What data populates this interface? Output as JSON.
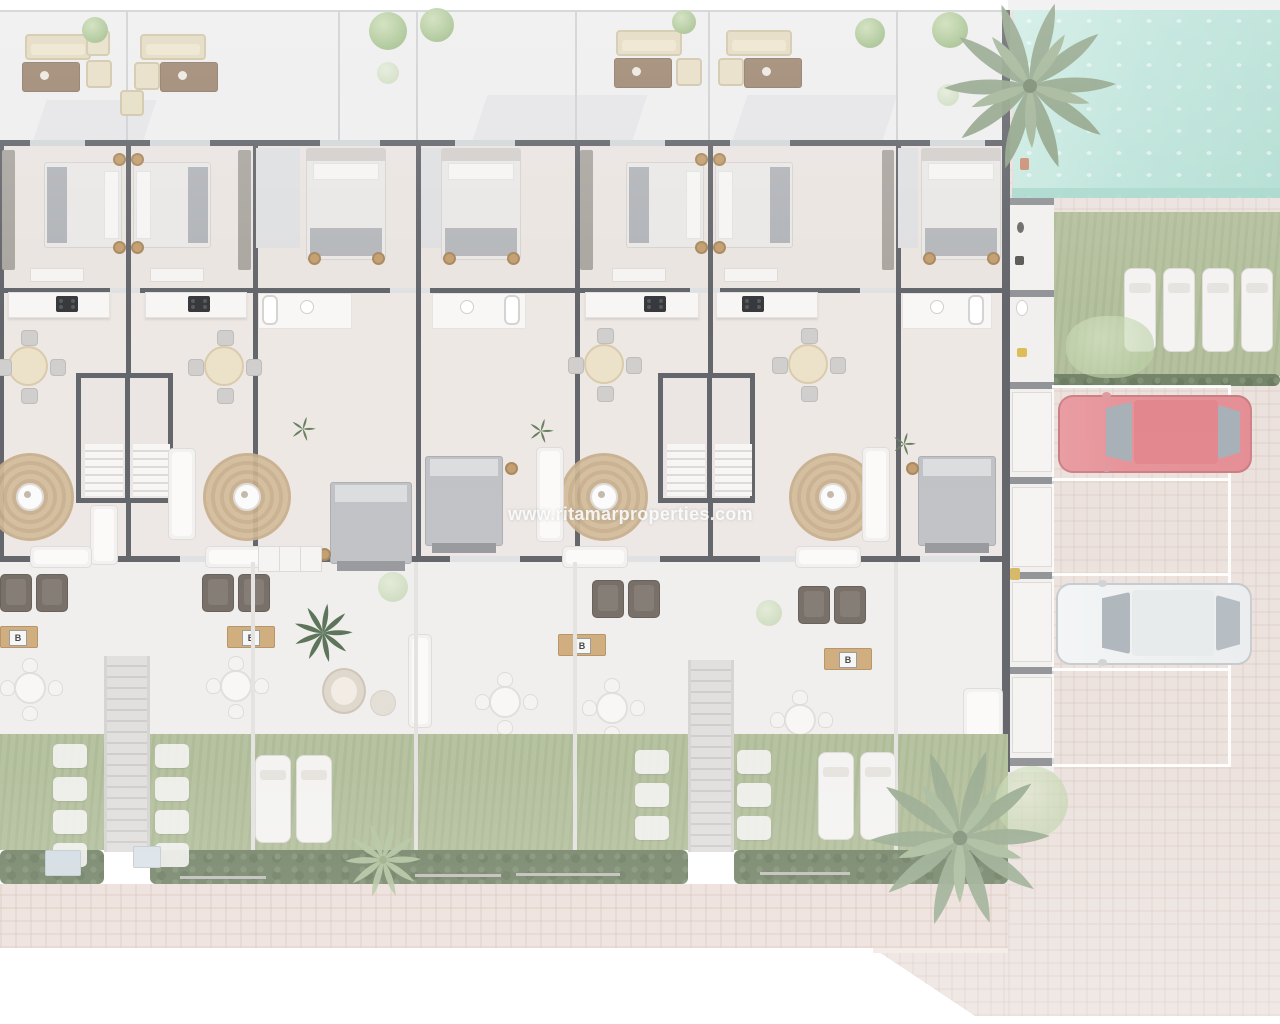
{
  "watermark": {
    "text": "www.ritamarproperties.com"
  },
  "labels": {
    "bbq_box": "B"
  },
  "palette": {
    "wall": "#494c52",
    "interior_floor": "#e7e0dc",
    "terrace_floor": "#ecebec",
    "patio_floor": "#edecea",
    "lawn_green": "#a8b68e",
    "hedge_green": "#5e7150",
    "pool_water": "#b2dfd4",
    "pavement": "#e8ddd8",
    "footpath": "#e9dad3",
    "rug_jute": "#c7ab83",
    "wood": "#c89f67",
    "red_car": "#e2838a",
    "white_car": "#eceff0",
    "tree_green": "#98b87e",
    "palm_green": "#7e9474"
  },
  "scene": {
    "type": "top-view residential floor plan render",
    "units_visible": 7,
    "pool_present": true,
    "lawn_loungers": 4,
    "garden_loungers": 4,
    "parking_spaces": 4,
    "cars": [
      {
        "name": "red-car",
        "color": "#e2838a"
      },
      {
        "name": "white-car",
        "color": "#eceff0"
      }
    ]
  }
}
